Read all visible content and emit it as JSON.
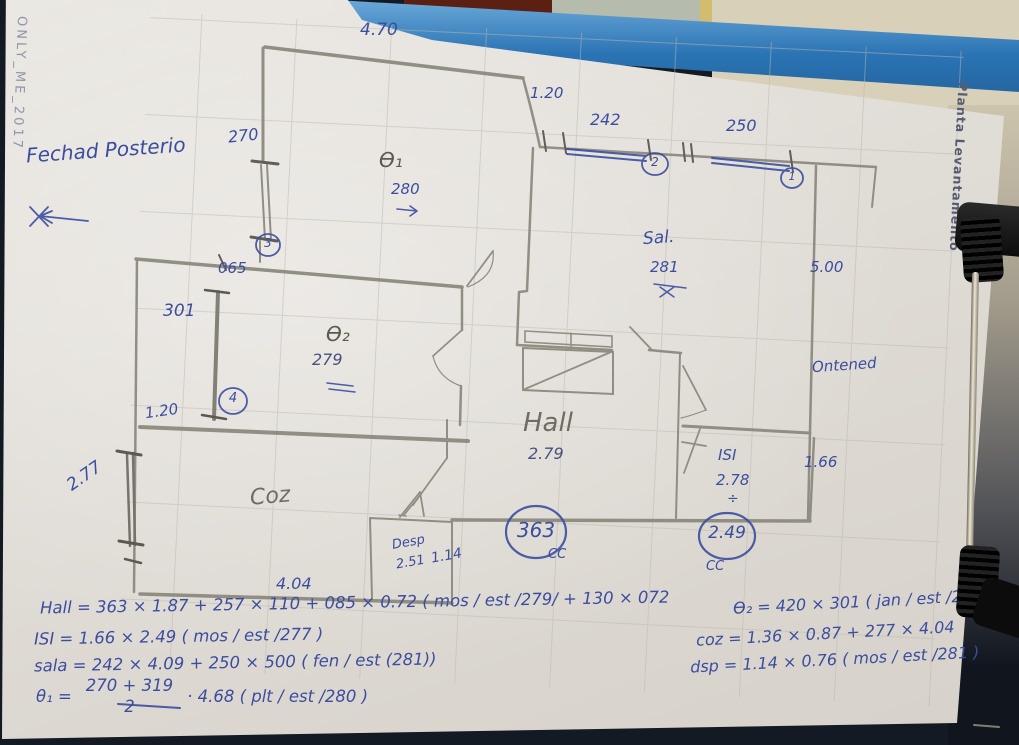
{
  "photo": {
    "watermark": "ONLY_ME_2017",
    "clipboard_label": "Planta Levantamento"
  },
  "notes": {
    "facade_note": "Fechad Posterio",
    "right_note": "Ontened"
  },
  "plan_labels": {
    "top_width": "4.70",
    "win_left_vert": "270",
    "wall_065": "065",
    "win_301": "301",
    "opening_120_left": "1.20",
    "win_277": "2.77",
    "room_coz": "Coz",
    "room_desp": "Desp",
    "desp_h": "2.51",
    "desp_w": "1.14",
    "coz_w": "4.04",
    "opening_120_top": "1.20",
    "win_242": "242",
    "win_250": "250",
    "room_sala": "Sal.",
    "sala_h": "281",
    "len_500": "5.00",
    "room_hall": "Hall",
    "hall_h": "2.79",
    "room_isi": "ISI",
    "isi_h": "2.78",
    "divide_sign": "÷",
    "len_166": "1.66",
    "hall_width_circle": "363",
    "isi_width_circle": "2.49",
    "cc": "CC",
    "q1_symbol": "Ɵ₁",
    "q1_h": "280",
    "q2_symbol": "Ɵ₂",
    "q2_h": "279"
  },
  "circled": {
    "n1": "1",
    "n2": "2",
    "n3": "3",
    "n4": "4"
  },
  "formulas": {
    "left": [
      "Hall = 363 × 1.87 + 257 × 110 + 085 × 0.72 ( mos / est /279/ + 130 × 072",
      "ISI = 1.66 × 2.49 ( mos / est /277 )",
      "sala = 242 × 4.09 + 250 × 500 ( fen / est (281))"
    ],
    "theta": {
      "lhs": "θ₁ =",
      "num": "270 + 319",
      "den": "2",
      "rhs": "· 4.68 ( plt / est /280 )"
    },
    "right": [
      "Ɵ₂ = 420 × 301 ( jan / est /279 )",
      "coz = 1.36 × 0.87 + 277 × 4.04",
      "dsp = 1.14 × 0.76 ( mos / est /281 )"
    ]
  }
}
